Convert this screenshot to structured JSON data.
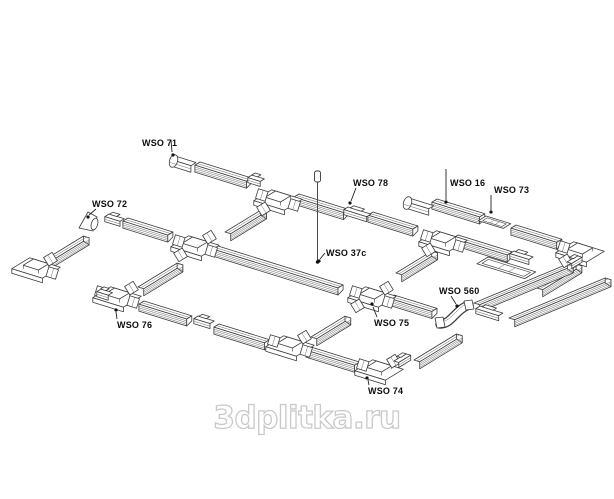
{
  "page": {
    "background": "#ffffff"
  },
  "watermark": {
    "text": "3dplitka.ru",
    "color": "#c9c9c9"
  },
  "diagram": {
    "description": "Exploded isometric line-art diagram of a track lighting rail system grid with labelled components",
    "ink_color": "#3a3a3a",
    "label_color": "#0d0d0d",
    "part_labels": [
      {
        "id": "wso-71",
        "text": "WSO 71",
        "tx": 142,
        "ty": 146,
        "lx1": 171,
        "ly1": 140,
        "lx2": 172,
        "ly2": 152,
        "dx": 173,
        "dy": 155
      },
      {
        "id": "wso-72",
        "text": "WSO 72",
        "tx": 92,
        "ty": 207,
        "lx1": 96,
        "ly1": 209,
        "lx2": 89,
        "ly2": 215,
        "dx": 88,
        "dy": 217
      },
      {
        "id": "wso-78",
        "text": "WSO 78",
        "tx": 353,
        "ty": 186,
        "lx1": 356,
        "ly1": 188,
        "lx2": 351,
        "ly2": 201,
        "dx": 350,
        "dy": 203
      },
      {
        "id": "wso-16",
        "text": "WSO 16",
        "tx": 450,
        "ty": 186,
        "lx1": 446,
        "ly1": 169,
        "lx2": 446,
        "ly2": 200,
        "dx": 446,
        "dy": 202
      },
      {
        "id": "wso-73",
        "text": "WSO 73",
        "tx": 494,
        "ty": 193,
        "lx1": 491,
        "ly1": 195,
        "lx2": 491,
        "ly2": 210,
        "dx": 491,
        "dy": 212
      },
      {
        "id": "wso-37c",
        "text": "WSO 37c",
        "tx": 326,
        "ty": 256,
        "lx1": 325,
        "ly1": 253,
        "lx2": 320,
        "ly2": 259,
        "dx": 319,
        "dy": 261
      },
      {
        "id": "wso-560",
        "text": "WSO 560",
        "tx": 439,
        "ty": 294,
        "lx1": 451,
        "ly1": 296,
        "lx2": 456,
        "ly2": 304,
        "dx": 457,
        "dy": 306
      },
      {
        "id": "wso-76",
        "text": "WSO 76",
        "tx": 117,
        "ty": 328,
        "lx1": 117,
        "ly1": 319,
        "lx2": 116,
        "ly2": 312,
        "dx": 116,
        "dy": 310
      },
      {
        "id": "wso-75",
        "text": "WSO 75",
        "tx": 374,
        "ty": 326,
        "lx1": 377,
        "ly1": 317,
        "lx2": 373,
        "ly2": 307,
        "dx": 372,
        "dy": 304
      },
      {
        "id": "wso-74",
        "text": "WSO 74",
        "tx": 368,
        "ty": 394,
        "lx1": 369,
        "ly1": 385,
        "lx2": 368,
        "ly2": 380,
        "dx": 367,
        "dy": 378
      }
    ],
    "suspension_marker": {
      "x": 317.5,
      "top": 172,
      "bottom": 261,
      "dot_y": 262
    }
  }
}
